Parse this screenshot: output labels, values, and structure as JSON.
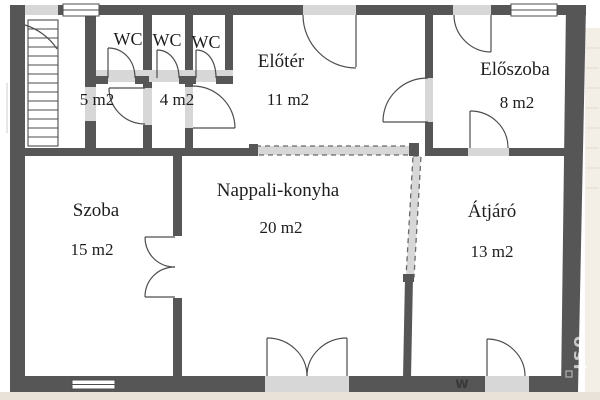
{
  "plan": {
    "rooms": [
      {
        "id": "wc1",
        "name": "WC",
        "area": "5 m2"
      },
      {
        "id": "wc2",
        "name": "WC",
        "area": "4 m2"
      },
      {
        "id": "wc3",
        "name": "WC",
        "area": ""
      },
      {
        "id": "eloter",
        "name": "Előtér",
        "area": "11 m2"
      },
      {
        "id": "eloszoba",
        "name": "Előszoba",
        "area": "8 m2"
      },
      {
        "id": "szoba",
        "name": "Szoba",
        "area": "15 m2"
      },
      {
        "id": "nappali",
        "name": "Nappali-konyha",
        "area": "20 m2"
      },
      {
        "id": "atjaro",
        "name": "Átjáró",
        "area": "13 m2"
      }
    ],
    "watermark": "osi",
    "watermark_small": "w"
  },
  "colors": {
    "wall": "#565656",
    "threshold": "#d7d7d7",
    "line": "#4d4d4d",
    "dashline": "#6a6a6a",
    "text": "#1d1d1d",
    "margin_bottom": "#e9e2d9",
    "margin_right": "#f3eee6",
    "tile_line": "#e2dacd",
    "watermark": "rgba(255,255,255,0.68)"
  }
}
